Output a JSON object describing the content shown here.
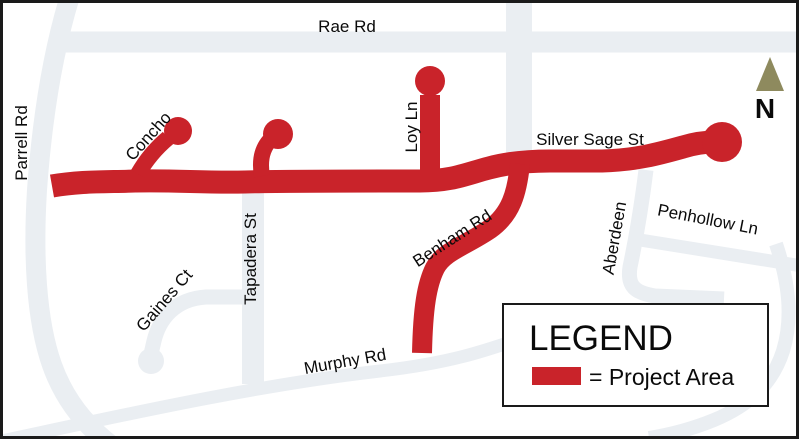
{
  "labels": {
    "rae_rd": "Rae Rd",
    "parrell_rd": "Parrell Rd",
    "concho": "Concho",
    "loy_ln": "Loy Ln",
    "silver_sage_st": "Silver Sage St",
    "tapadera_st": "Tapadera St",
    "gaines_ct": "Gaines Ct",
    "benham_rd": "Benham Rd",
    "aberdeen": "Aberdeen",
    "penhollow_ln": "Penhollow Ln",
    "murphy_rd": "Murphy Rd"
  },
  "north": {
    "label": "N"
  },
  "legend": {
    "title": "LEGEND",
    "item": {
      "swatch_color": "#C9232A",
      "label": "= Project Area"
    }
  },
  "colors": {
    "project_red": "#C9232A",
    "road_gray": "#EAEEF2",
    "north_arrow": "#8E8A5E",
    "label_text": "#0A0A0A",
    "frame_border": "#1A1A1A",
    "background": "#FFFFFF"
  }
}
